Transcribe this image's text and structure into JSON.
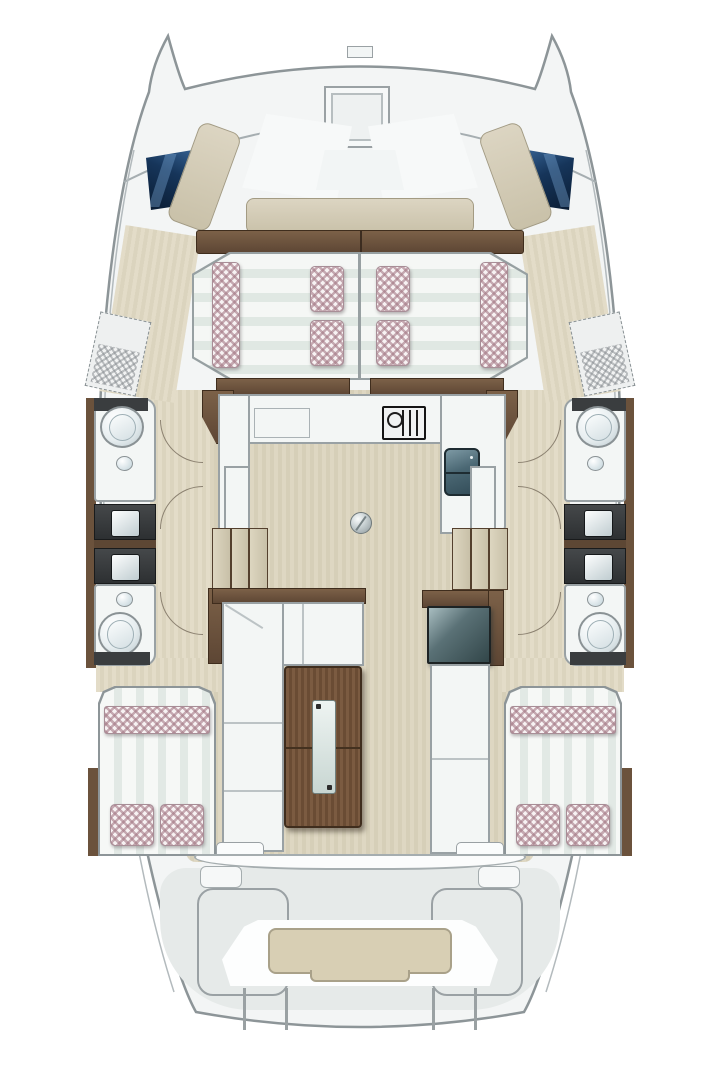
{
  "meta": {
    "title": "Catamaran deck and accommodation floor plan",
    "view": "top-down plan",
    "visible_text": []
  },
  "palette": {
    "background": "#ffffff",
    "hull_fill": "#f3f5f5",
    "hull_outline": "#8d9598",
    "aft_deck": "#e6eae9",
    "wood_floor": "#dbd4be",
    "dark_wood_trim": "#6b523c",
    "table_wood": "#6e5340",
    "upholstery_beige": "#d2cbb8",
    "mattress_stripe": "#e2e9e5",
    "pillow_checker": "#a47885",
    "window_navy_dark": "#0a1c33",
    "window_navy_light": "#3c6b9e",
    "counter_white": "#f3f6f5",
    "vanity_dark": "#36393b",
    "sink_teal": "#44606c"
  },
  "plan": {
    "foredeck": {
      "label": "Foredeck with bow lounge seating",
      "hatch": "square deck hatch",
      "console": "center backrest console",
      "windows": [
        "port forward hull window",
        "starboard forward hull window"
      ],
      "lounge_parts": [
        "port arm",
        "starboard arm",
        "forward bench"
      ]
    },
    "forward_berth": {
      "label": "Forward double sunpad berth (split port/starboard)",
      "pillow_count": 4,
      "bolster_count": 2,
      "finish": "striped mattress with checkered pillows"
    },
    "galley": {
      "label": "U-shaped galley",
      "stove": "gas hob with grate",
      "sink": "double teal sink with faucets",
      "counter_hatch": "counter access hatch",
      "floor_fitting": "round deck filler"
    },
    "port_hull": {
      "label": "Port hull",
      "forward_head": {
        "label": "forward head",
        "fixtures": [
          "toilet",
          "round washbasin"
        ]
      },
      "aft_head": {
        "label": "aft head",
        "fixtures": [
          "round washbasin",
          "toilet"
        ]
      },
      "vanity_count": 2,
      "companionway_steps": 3,
      "bow_storage": "dashed storage locker with mesh cushion"
    },
    "starboard_hull": {
      "label": "Starboard hull (mirror of port)",
      "forward_head": {
        "label": "forward head",
        "fixtures": [
          "toilet",
          "round washbasin"
        ]
      },
      "aft_head": {
        "label": "aft head",
        "fixtures": [
          "round washbasin",
          "toilet"
        ]
      },
      "vanity_count": 2,
      "companionway_steps": 3,
      "bow_storage": "dashed storage locker with mesh cushion"
    },
    "salon": {
      "label": "Salon / dinette",
      "sofa": "L-shaped settee",
      "table": "wood dining table with glass inlay",
      "bench": "starboard chaise bench",
      "cooler": "teal cool-box top"
    },
    "aft_cabins": {
      "port": {
        "label": "Port aft double berth",
        "pillow_count": 2
      },
      "starboard": {
        "label": "Starboard aft double berth",
        "pillow_count": 2
      }
    },
    "aft_deck": {
      "label": "Aft cockpit and transom",
      "platform": "center transom seat with beige cushion pad",
      "locker_outlines": 2,
      "transom_step_lines": 4
    }
  }
}
